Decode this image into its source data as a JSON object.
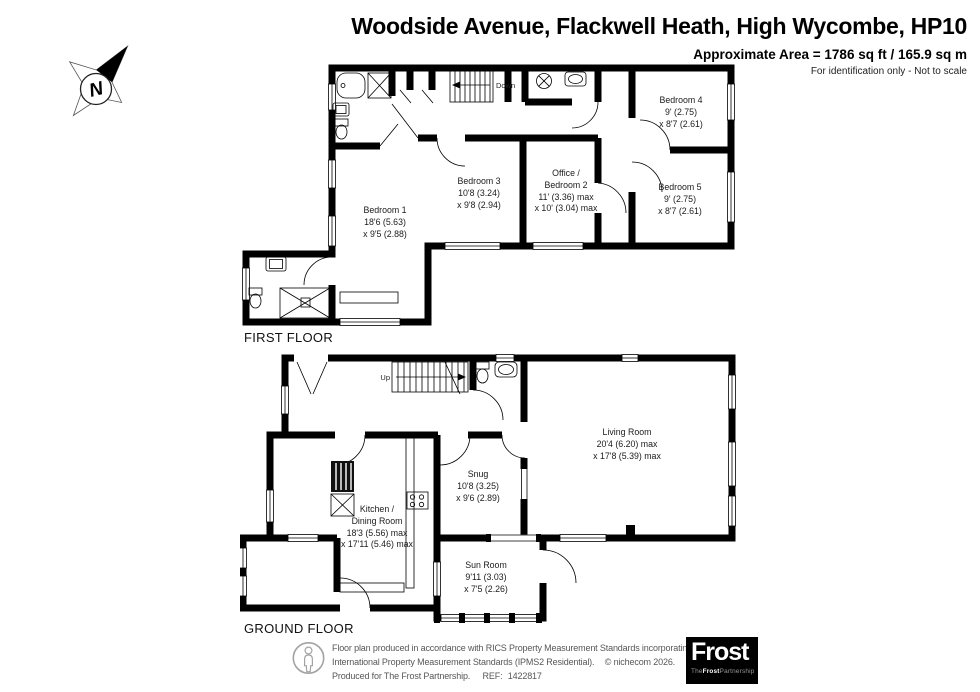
{
  "header": {
    "title": "Woodside Avenue, Flackwell Heath, High Wycombe, HP10",
    "area": "Approximate Area = 1786 sq ft / 165.9 sq m",
    "disclaimer": "For identification only - Not to scale"
  },
  "compass": {
    "north_label": "N"
  },
  "first_floor": {
    "label": "FIRST FLOOR",
    "stairs_label": "Down",
    "rooms": [
      {
        "name1": "Bedroom 1",
        "name2": "",
        "dim1": "18'6 (5.63)",
        "dim2": "x 9'5 (2.88)"
      },
      {
        "name1": "Bedroom 3",
        "name2": "",
        "dim1": "10'8 (3.24)",
        "dim2": "x 9'8 (2.94)"
      },
      {
        "name1": "Office /",
        "name2": "Bedroom 2",
        "dim1": "11' (3.36) max",
        "dim2": "x 10' (3.04) max"
      },
      {
        "name1": "Bedroom 4",
        "name2": "",
        "dim1": "9' (2.75)",
        "dim2": "x 8'7 (2.61)"
      },
      {
        "name1": "Bedroom 5",
        "name2": "",
        "dim1": "9' (2.75)",
        "dim2": "x 8'7 (2.61)"
      }
    ]
  },
  "ground_floor": {
    "label": "GROUND FLOOR",
    "stairs_label": "Up",
    "rooms": [
      {
        "name1": "Living Room",
        "name2": "",
        "dim1": "20'4 (6.20) max",
        "dim2": "x 17'8 (5.39) max"
      },
      {
        "name1": "Snug",
        "name2": "",
        "dim1": "10'8 (3.25)",
        "dim2": "x 9'6 (2.89)"
      },
      {
        "name1": "Kitchen /",
        "name2": "Dining Room",
        "dim1": "18'3 (5.56) max",
        "dim2": "x 17'11 (5.46) max"
      },
      {
        "name1": "Sun Room",
        "name2": "",
        "dim1": "9'11 (3.03)",
        "dim2": "x 7'5 (2.26)"
      }
    ]
  },
  "footer": {
    "line1": "Floor plan produced in accordance with RICS Property Measurement Standards incorporating",
    "line2_std": "International Property Measurement Standards (IPMS2 Residential).",
    "line2_copy": "© nichecom 2026.",
    "line3_produced": "Produced for The Frost Partnership.",
    "line3_ref_label": "REF:",
    "line3_ref_value": "1422817",
    "logo": {
      "main": "Frost",
      "sub_the": "The",
      "sub_frost": "Frost",
      "sub_partnership": "Partnership"
    }
  }
}
